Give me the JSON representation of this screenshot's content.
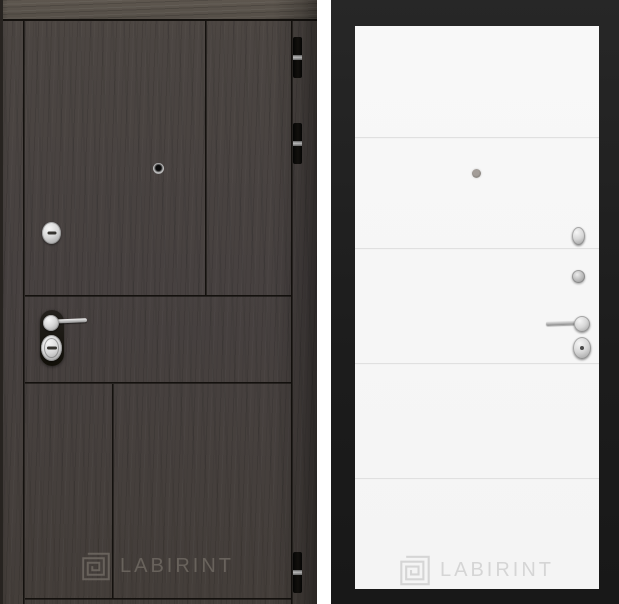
{
  "page": {
    "background": "#ffffff"
  },
  "left_door": {
    "label": "dark-wenge-exterior-door-panel",
    "brand": "LABIRINT",
    "colors": {
      "top_frame": "#59524b",
      "leaf": "#48423e",
      "groove": "#14110e",
      "hinge": "#0e0d0b",
      "chrome_hardware": "#cccccc",
      "logo": "#6f6962"
    },
    "icons": {
      "logo_icon": "square-spiral-labyrinth",
      "hardware": [
        "peephole",
        "cylinder-cover",
        "lever-handle",
        "key-cylinder",
        "hinge",
        "hinge",
        "hinge"
      ]
    }
  },
  "right_door": {
    "label": "white-interior-door-panel",
    "brand": "LABIRINT",
    "colors": {
      "frame": "#1f1f1f",
      "panel": "#f6f6f6",
      "groove": "#d6d6d6",
      "chrome_hardware": "#c4c4c4",
      "logo": "#d5d5d5"
    },
    "icons": {
      "logo_icon": "square-spiral-labyrinth",
      "hardware": [
        "peephole",
        "escutcheon",
        "thumb-turn-knob",
        "lever-handle",
        "key-escutcheon"
      ]
    }
  }
}
